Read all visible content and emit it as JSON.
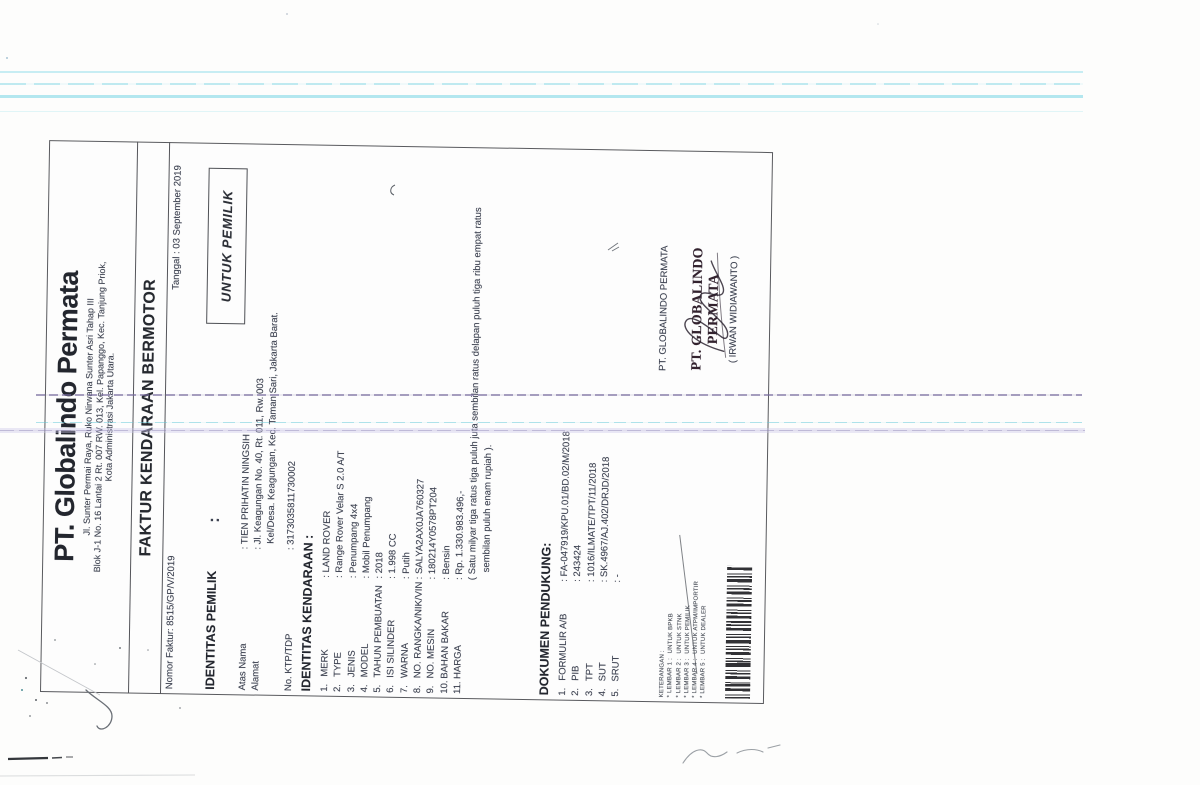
{
  "company": {
    "name": "PT. Globalindo Permata",
    "address_line1": "Jl. Sunter Permai Raya, Ruko Nirwana Sunter Asri Tahap III",
    "address_line2": "Blok J-1 No. 16 Lantai 2 Rt. 007 RW. 013, Kel. Papanggo, Kec. Tanjung Priok,",
    "address_line3": "Kota Administrasi Jakarta Utara."
  },
  "form": {
    "title": "FAKTUR KENDARAAN BERMOTOR",
    "invoice_number_line": "Nomor Faktur: 8515/GP/V/2019",
    "date_line": "Tanggal : 03 September 2019",
    "copy_for": "UNTUK PEMILIK"
  },
  "owner": {
    "heading": "IDENTITAS PEMILIK",
    "heading_colon": ":",
    "rows": [
      {
        "label": "Atas Nama",
        "value": ": TIEN PRIHATIN NINGSIH"
      },
      {
        "label": "Alamat",
        "value": ": Jl. Keagungan No. 40, Rt. 011, Rw. 003",
        "value2": "Kel/Desa. Keagungan, Kec. Taman Sari, Jakarta Barat."
      },
      {
        "label": "No. KTP/TDP",
        "value": ": 3173035811730002"
      }
    ]
  },
  "vehicle": {
    "heading": "IDENTITAS KENDARAAN :",
    "items": [
      {
        "no": "1.",
        "label": "MERK",
        "value": ": LAND ROVER"
      },
      {
        "no": "2.",
        "label": "TYPE",
        "value": ": Range Rover Velar S 2.0 A/T"
      },
      {
        "no": "3.",
        "label": "JENIS",
        "value": ": Penumpang 4x4"
      },
      {
        "no": "4.",
        "label": "MODEL",
        "value": ": Mobil Penumpang"
      },
      {
        "no": "5.",
        "label": "TAHUN PEMBUATAN",
        "value": ": 2018"
      },
      {
        "no": "6.",
        "label": "ISI SILINDER",
        "value": ": 1.998 CC"
      },
      {
        "no": "7.",
        "label": "WARNA",
        "value": ": Putih"
      },
      {
        "no": "8.",
        "label": "NO. RANGKA/NIK/VIN",
        "value": ": SALYA2AX0JA760327"
      },
      {
        "no": "9.",
        "label": "NO. MESIN",
        "value": ": 180214Y0578PT204"
      },
      {
        "no": "10.",
        "label": "BAHAN BAKAR",
        "value": ": Bensin"
      },
      {
        "no": "11.",
        "label": "HARGA",
        "value": ": Rp. 1.330.983.496,-"
      }
    ],
    "price_note_line1": "( Satu milyar tiga ratus tiga puluh juta sembilan ratus delapan puluh tiga ribu empat ratus",
    "price_note_line2": "sembilan puluh enam rupiah )."
  },
  "documents": {
    "heading": "DOKUMEN PENDUKUNG:",
    "items": [
      {
        "no": "1.",
        "label": "FORMULIR A/B",
        "value": ": FA-047919/KPU.01/BD.02/M/2018"
      },
      {
        "no": "2.",
        "label": "PIB",
        "value": ": 243424"
      },
      {
        "no": "3.",
        "label": "TPT",
        "value": ": 1016/ILMATE/TPT/11/2018"
      },
      {
        "no": "4.",
        "label": "SUT",
        "value": ": SK.4967/AJ.402/DRJD/2018"
      },
      {
        "no": "5.",
        "label": "SRUT",
        "value": ": -"
      }
    ]
  },
  "signature": {
    "company": "PT. GLOBALINDO PERMATA",
    "stamp_name": "PT. GLOBALINDO PERMATA",
    "signer": "( IRWAN WIDIAWANTO )"
  },
  "keterangan": {
    "title": "KETERANGAN :",
    "items": [
      {
        "label": "* LEMBAR 1 :",
        "value": "UNTUK BPKB"
      },
      {
        "label": "* LEMBAR 2 :",
        "value": "UNTUK STNK"
      },
      {
        "label": "* LEMBAR 3 :",
        "value": "UNTUK PEMILIK"
      },
      {
        "label": "* LEMBAR 4 :",
        "value": "UNTUK ATPM/IMPORTIR"
      },
      {
        "label": "* LEMBAR 5 :",
        "value": "UNTUK DEALER"
      }
    ]
  }
}
